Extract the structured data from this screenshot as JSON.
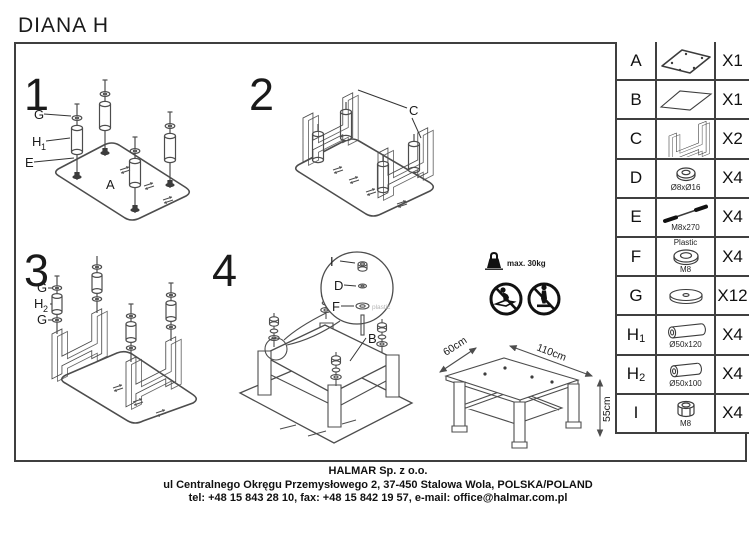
{
  "title": "DIANA H",
  "steps": {
    "s1": {
      "number": "1",
      "g": "G",
      "h": "H",
      "h_sub": "1",
      "e": "E",
      "a": "A"
    },
    "s2": {
      "number": "2",
      "c": "C"
    },
    "s3": {
      "number": "3",
      "g1": "G",
      "h": "H",
      "h_sub": "2",
      "g2": "G"
    },
    "s4": {
      "number": "4",
      "i": "I",
      "d": "D",
      "f": "F",
      "f_note": "plastic",
      "b": "B"
    }
  },
  "parts_table": {
    "rows": [
      {
        "letter": "A",
        "qty": "X1",
        "icon": "glass-top-icon"
      },
      {
        "letter": "B",
        "qty": "X1",
        "icon": "glass-shelf-icon"
      },
      {
        "letter": "C",
        "qty": "X2",
        "icon": "frame-icon"
      },
      {
        "letter": "D",
        "qty": "X4",
        "spec": "Ø8xØ16",
        "icon": "washer-icon"
      },
      {
        "letter": "E",
        "qty": "X4",
        "spec": "M8x270",
        "icon": "bolt-icon"
      },
      {
        "letter": "F",
        "qty": "X4",
        "spec_top": "Plastic",
        "spec": "M8",
        "icon": "plastic-washer-icon"
      },
      {
        "letter": "G",
        "qty": "X12",
        "icon": "pad-icon"
      },
      {
        "letter": "H",
        "letter_sub": "1",
        "qty": "X4",
        "spec": "Ø50x120",
        "icon": "leg-cylinder-icon"
      },
      {
        "letter": "H",
        "letter_sub": "2",
        "qty": "X4",
        "spec": "Ø50x100",
        "icon": "spacer-cylinder-icon"
      },
      {
        "letter": "I",
        "qty": "X4",
        "spec": "M8",
        "icon": "nut-icon"
      }
    ]
  },
  "warnings": {
    "max_load": "max. 30kg",
    "icons": [
      "weight-icon",
      "no-sitting-icon",
      "no-standing-icon"
    ]
  },
  "dimensions": {
    "width": "110cm",
    "depth": "60cm",
    "height": "55cm"
  },
  "footer": {
    "company": "HALMAR Sp. z o.o.",
    "address": "ul Centralnego Okręgu Przemysłowego 2, 37-450 Stalowa Wola, POLSKA/POLAND",
    "contact": "tel: +48 15 843 28 10, fax: +48 15 842 19 57, e-mail: office@halmar.com.pl"
  }
}
